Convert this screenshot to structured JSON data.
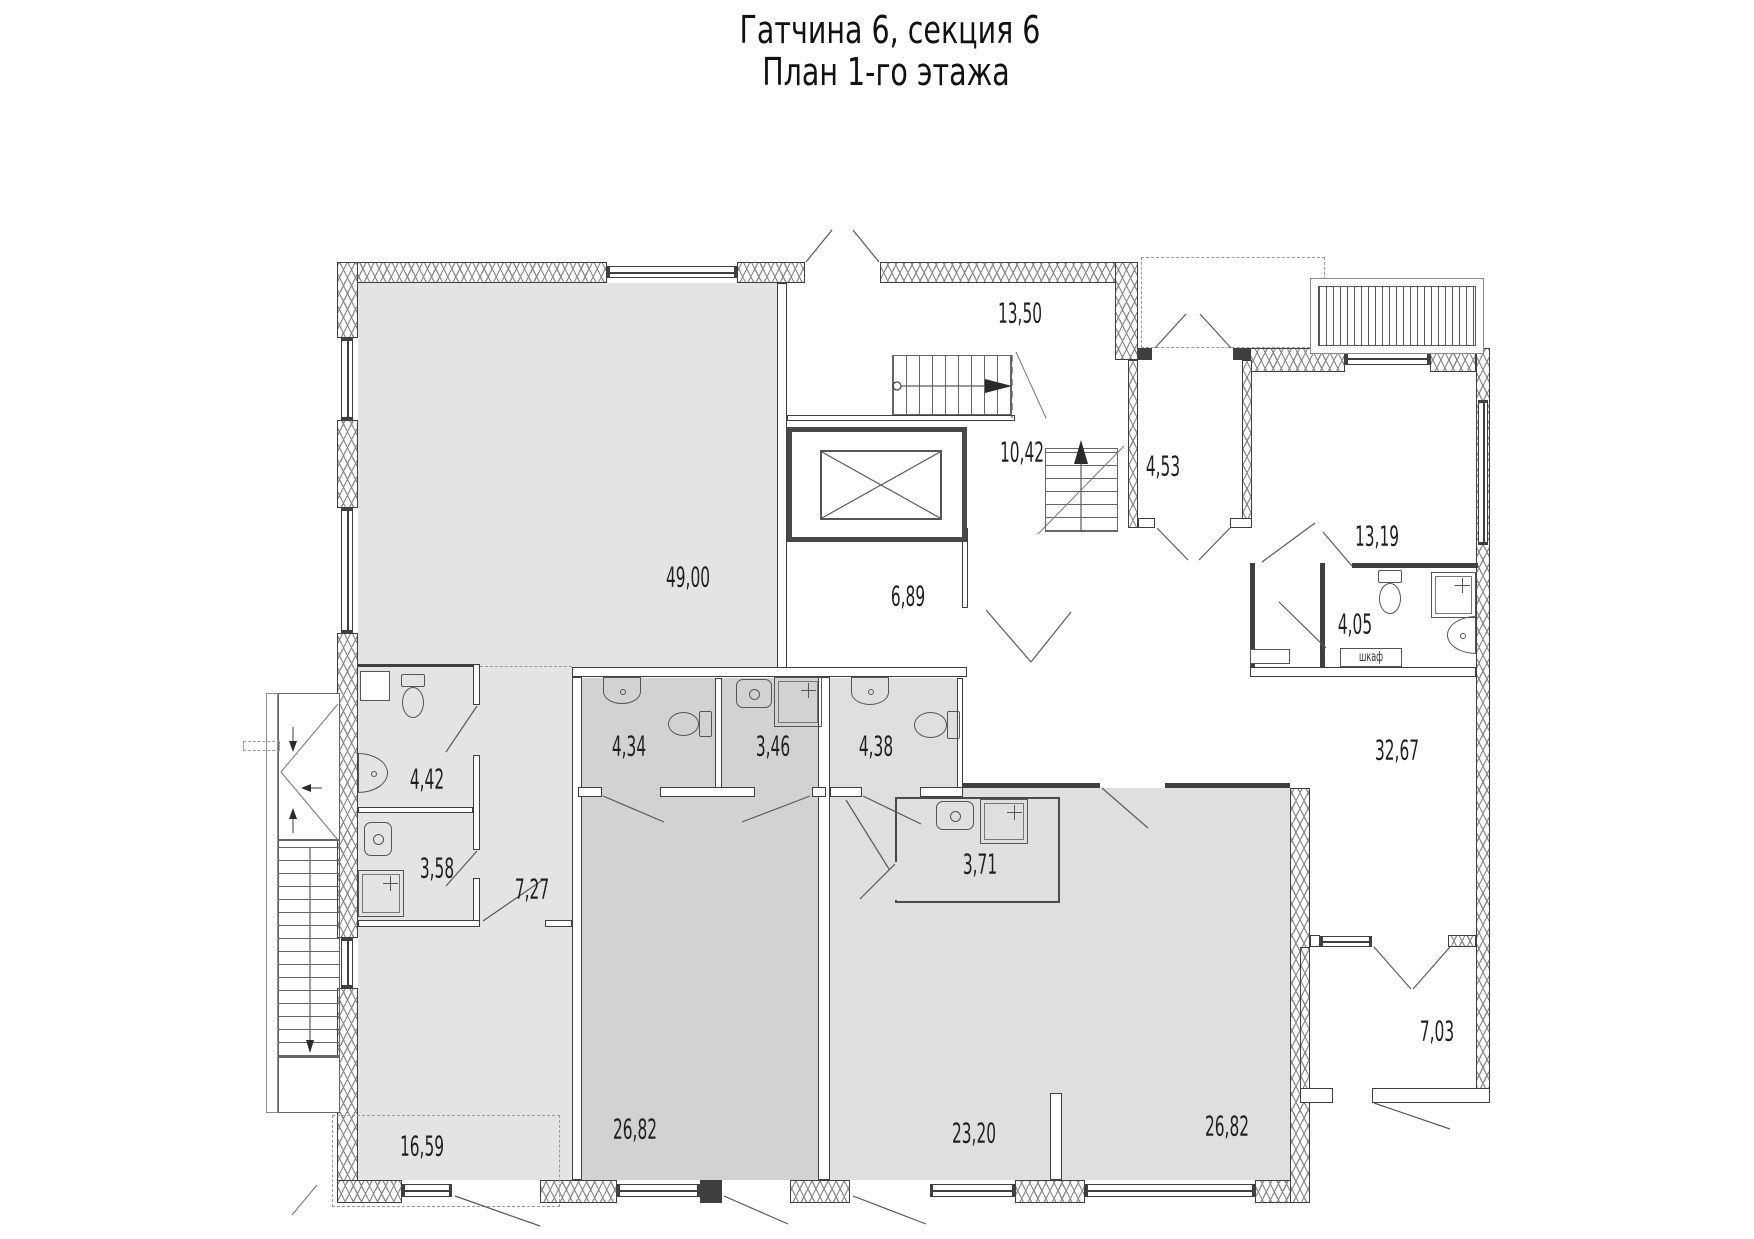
{
  "title": {
    "line1": "Гатчина 6, секция 6",
    "line2": "План 1-го этажа"
  },
  "labels": {
    "closet": "шкаф"
  },
  "rooms": [
    {
      "id": "stair-hall",
      "area": "13,50"
    },
    {
      "id": "stair-lower",
      "area": "10,42"
    },
    {
      "id": "tambour",
      "area": "4,53"
    },
    {
      "id": "hall",
      "area": "13,19"
    },
    {
      "id": "bathroom-hall",
      "area": "4,05"
    },
    {
      "id": "big-room",
      "area": "49,00"
    },
    {
      "id": "lift-hall",
      "area": "6,89"
    },
    {
      "id": "wc-unit1",
      "area": "4,42"
    },
    {
      "id": "shower-unit1",
      "area": "3,58"
    },
    {
      "id": "lobby-unit1",
      "area": "7,27"
    },
    {
      "id": "wc-unit2",
      "area": "4,34"
    },
    {
      "id": "shower-unit2",
      "area": "3,46"
    },
    {
      "id": "wc-unit3",
      "area": "4,38"
    },
    {
      "id": "shower-unit3",
      "area": "3,71"
    },
    {
      "id": "corridor",
      "area": "32,67"
    },
    {
      "id": "room-unit1-low",
      "area": "16,59"
    },
    {
      "id": "room-unit2",
      "area": "26,82"
    },
    {
      "id": "room-unit3-a",
      "area": "23,20"
    },
    {
      "id": "room-unit3-b",
      "area": "26,82"
    },
    {
      "id": "balcony",
      "area": "7,03"
    }
  ],
  "colors": {
    "line": "#3f3f3f",
    "hatch": "#8a8a8a",
    "unit1": "#e4e4e4",
    "unit2": "#d2d2d2",
    "unit3": "#dfdfdf",
    "txt": "#1f1f1f"
  }
}
